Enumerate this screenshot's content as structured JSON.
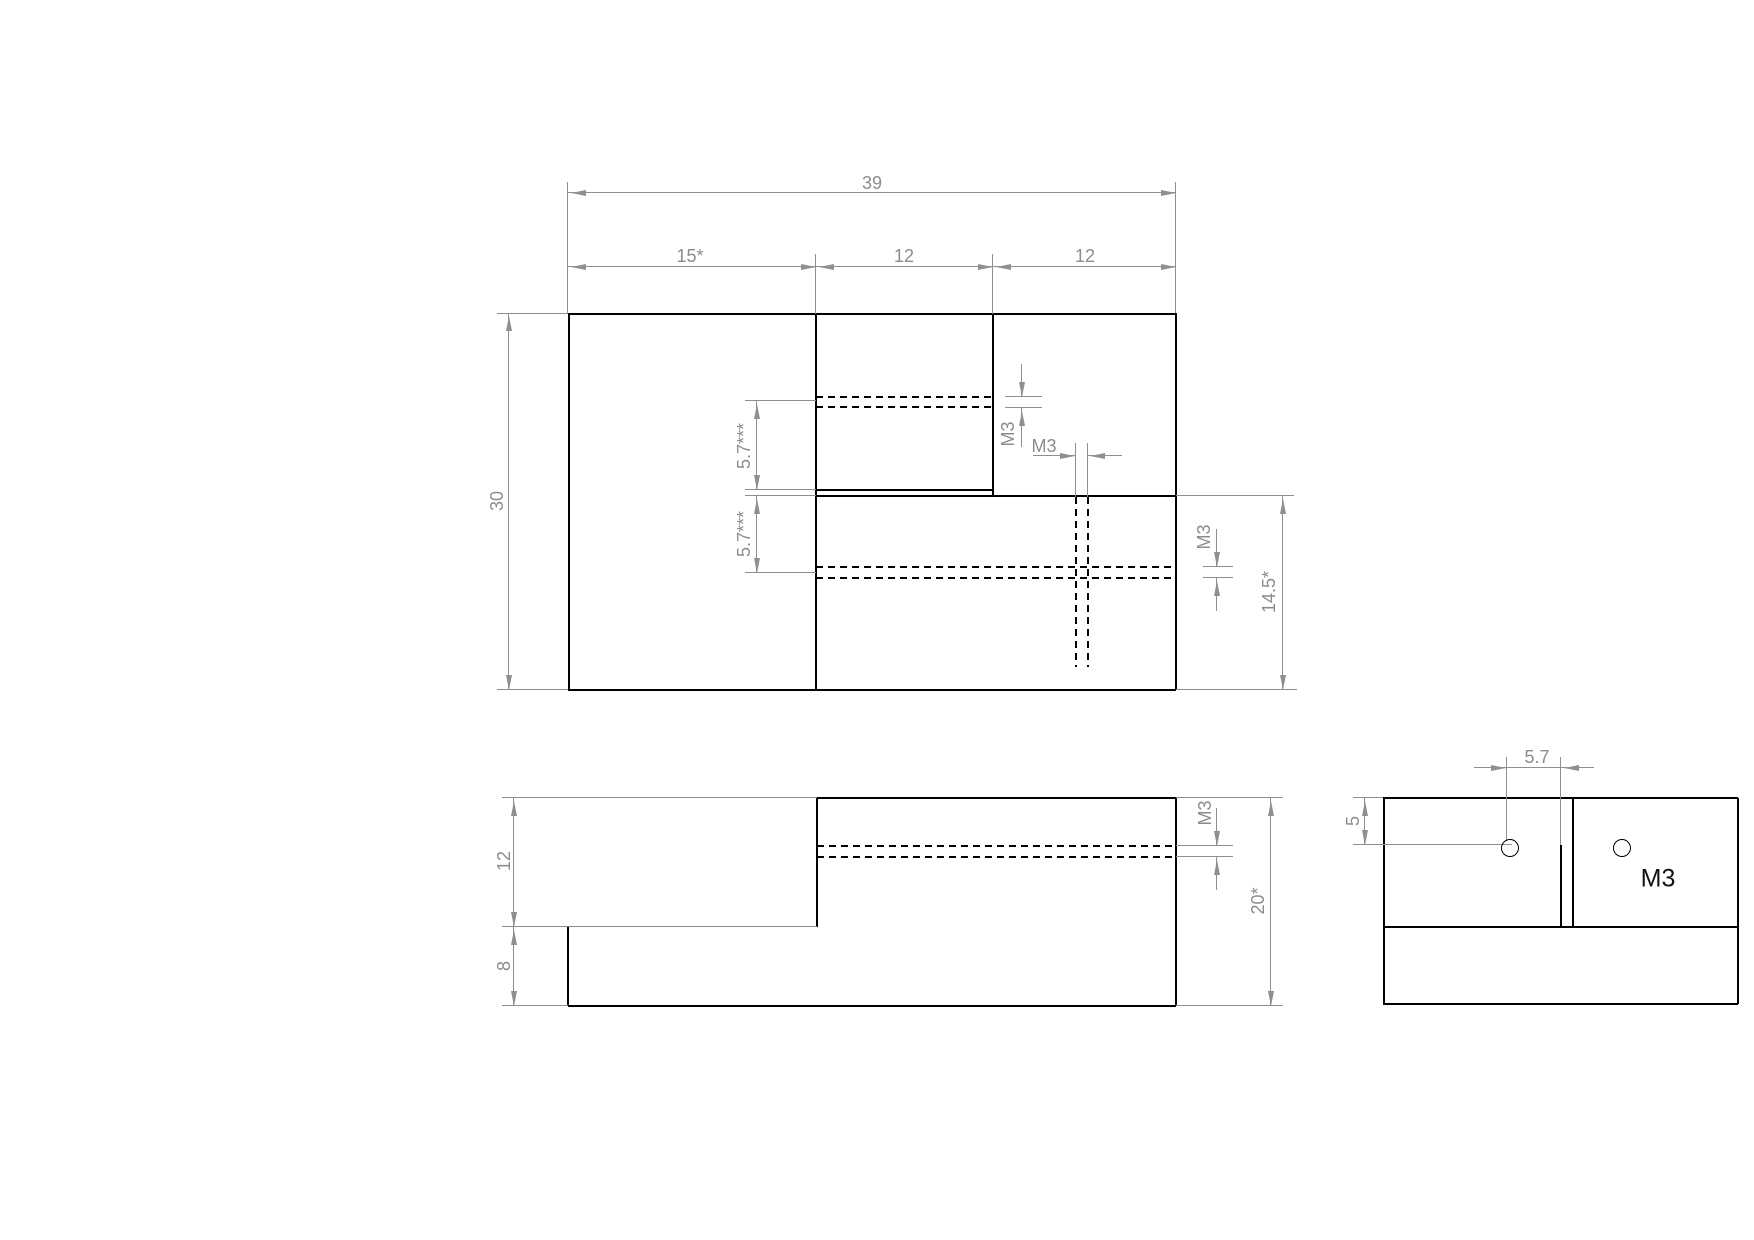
{
  "sheet": {
    "kind": "CAD 3-view technical drawing",
    "background": "#ffffff",
    "part_line_color": "#000000",
    "dimension_color": "#8f8f8f",
    "thread_text_color": "#111111"
  },
  "views": {
    "top": {
      "overall_width": "39",
      "left_width": "15*",
      "middle_width": "12",
      "right_width": "12",
      "overall_depth": "30",
      "upper_hole_offset": "5.7***",
      "lower_hole_offset": "5.7***",
      "upper_hole_thread": "M3",
      "side_hole_thread": "M3",
      "lower_hole_thread": "M3",
      "front_depth": "14.5*"
    },
    "front": {
      "upper_height": "12",
      "base_height": "8",
      "total_height": "20*",
      "hole_thread": "M3"
    },
    "side": {
      "hole_to_step": "5.7",
      "hole_from_top": "5",
      "thread_label": "M3"
    }
  }
}
